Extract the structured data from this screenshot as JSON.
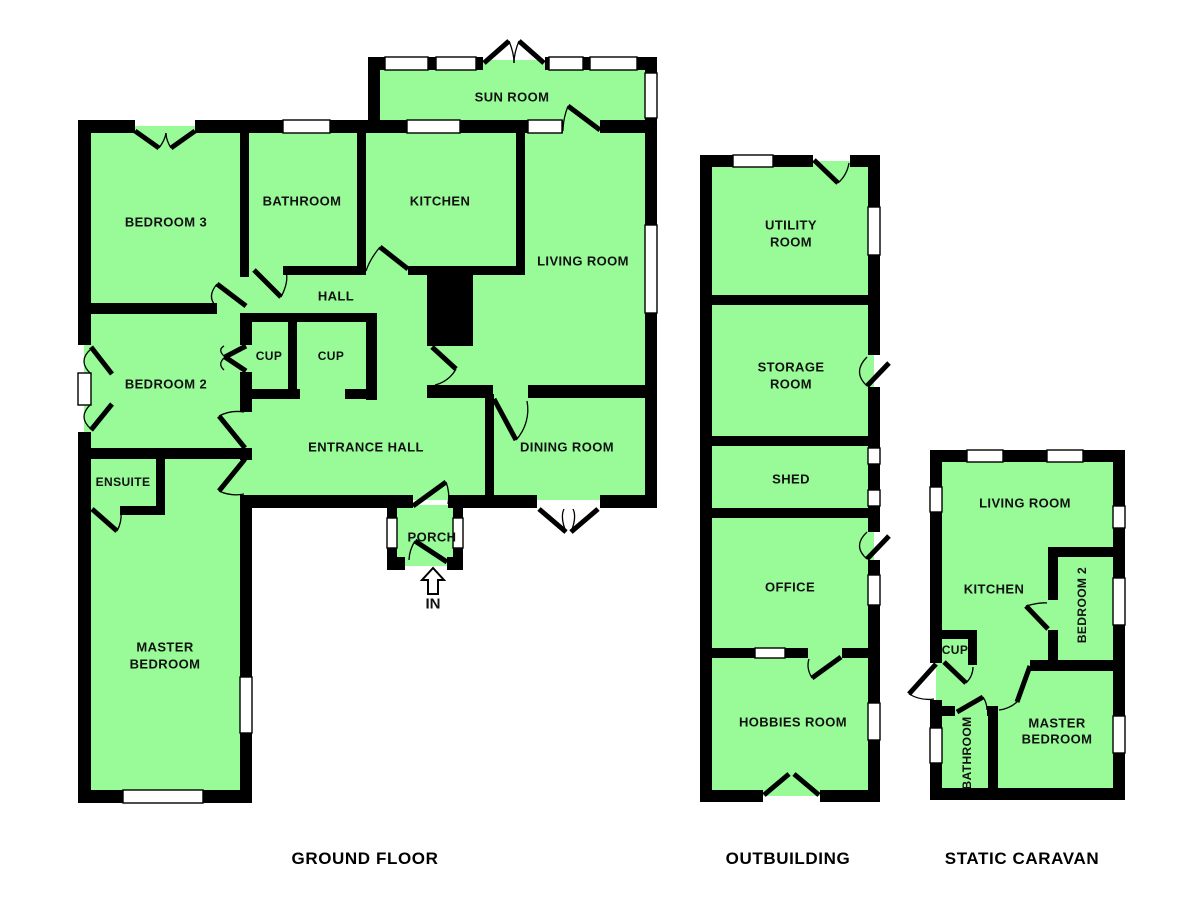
{
  "colors": {
    "floor": "#98FB98",
    "wall": "#000000",
    "window": "#ffffff",
    "text": "#111111"
  },
  "titles": {
    "ground_floor": {
      "text": "GROUND FLOOR"
    },
    "outbuilding": {
      "text": "OUTBUILDING"
    },
    "static_caravan": {
      "text": "STATIC CARAVAN"
    }
  },
  "entrance": {
    "label": "IN",
    "arrow_points": "433,568 422,580 428,580 428,594 438,594 438,580 444,580",
    "x": 433,
    "y": 604
  },
  "plan": {
    "floors": [
      [
        374,
        60,
        277,
        73
      ],
      [
        84,
        126,
        567,
        268
      ],
      [
        84,
        394,
        567,
        106
      ],
      [
        84,
        450,
        162,
        347
      ],
      [
        390,
        505,
        70,
        61
      ],
      [
        706,
        161,
        168,
        635
      ],
      [
        936,
        456,
        183,
        338
      ]
    ],
    "walls": [
      [
        368,
        57,
        115,
        13
      ],
      [
        545,
        57,
        112,
        13
      ],
      [
        78,
        120,
        57,
        13
      ],
      [
        195,
        120,
        368,
        13
      ],
      [
        600,
        120,
        57,
        13
      ],
      [
        283,
        266,
        82,
        9
      ],
      [
        408,
        266,
        117,
        9
      ],
      [
        78,
        303,
        139,
        11
      ],
      [
        243,
        313,
        134,
        9
      ],
      [
        243,
        389,
        57,
        10
      ],
      [
        345,
        389,
        32,
        10
      ],
      [
        427,
        385,
        66,
        13
      ],
      [
        528,
        385,
        129,
        13
      ],
      [
        78,
        448,
        170,
        11
      ],
      [
        120,
        506,
        45,
        9
      ],
      [
        243,
        495,
        170,
        13
      ],
      [
        448,
        495,
        89,
        13
      ],
      [
        600,
        495,
        57,
        13
      ],
      [
        387,
        557,
        18,
        13
      ],
      [
        447,
        557,
        16,
        13
      ],
      [
        78,
        790,
        45,
        13
      ],
      [
        203,
        790,
        49,
        13
      ],
      [
        78,
        120,
        13,
        225
      ],
      [
        78,
        432,
        13,
        371
      ],
      [
        240,
        120,
        9,
        157
      ],
      [
        357,
        120,
        9,
        155
      ],
      [
        516,
        126,
        9,
        149
      ],
      [
        368,
        57,
        12,
        76
      ],
      [
        645,
        57,
        12,
        16
      ],
      [
        645,
        118,
        12,
        107
      ],
      [
        645,
        313,
        12,
        195
      ],
      [
        288,
        313,
        9,
        86
      ],
      [
        366,
        313,
        11,
        87
      ],
      [
        240,
        313,
        12,
        32
      ],
      [
        240,
        372,
        12,
        40
      ],
      [
        240,
        448,
        12,
        12
      ],
      [
        240,
        495,
        12,
        182
      ],
      [
        240,
        733,
        12,
        70
      ],
      [
        156,
        448,
        9,
        63
      ],
      [
        485,
        394,
        9,
        107
      ],
      [
        387,
        505,
        10,
        13
      ],
      [
        387,
        548,
        10,
        22
      ],
      [
        453,
        505,
        10,
        13
      ],
      [
        453,
        548,
        10,
        22
      ],
      [
        700,
        155,
        113,
        12
      ],
      [
        850,
        155,
        30,
        12
      ],
      [
        706,
        295,
        168,
        10
      ],
      [
        706,
        436,
        168,
        10
      ],
      [
        706,
        508,
        168,
        10
      ],
      [
        706,
        648,
        49,
        10
      ],
      [
        785,
        648,
        23,
        10
      ],
      [
        842,
        648,
        32,
        10
      ],
      [
        700,
        790,
        63,
        12
      ],
      [
        820,
        790,
        60,
        12
      ],
      [
        700,
        155,
        12,
        647
      ],
      [
        868,
        155,
        12,
        52
      ],
      [
        868,
        255,
        12,
        100
      ],
      [
        868,
        387,
        12,
        61
      ],
      [
        868,
        464,
        12,
        26
      ],
      [
        868,
        506,
        12,
        26
      ],
      [
        868,
        560,
        12,
        15
      ],
      [
        868,
        605,
        12,
        98
      ],
      [
        868,
        740,
        12,
        62
      ],
      [
        930,
        450,
        195,
        12
      ],
      [
        1048,
        547,
        77,
        10
      ],
      [
        1030,
        660,
        95,
        11
      ],
      [
        936,
        630,
        40,
        9
      ],
      [
        936,
        706,
        19,
        10
      ],
      [
        987,
        706,
        11,
        10
      ],
      [
        930,
        788,
        195,
        12
      ],
      [
        930,
        450,
        12,
        37
      ],
      [
        930,
        512,
        12,
        151
      ],
      [
        930,
        700,
        12,
        28
      ],
      [
        930,
        763,
        12,
        37
      ],
      [
        1113,
        450,
        12,
        56
      ],
      [
        1113,
        528,
        12,
        50
      ],
      [
        1113,
        625,
        12,
        91
      ],
      [
        1113,
        753,
        12,
        47
      ],
      [
        1048,
        547,
        10,
        53
      ],
      [
        1048,
        630,
        10,
        35
      ],
      [
        968,
        630,
        9,
        35
      ],
      [
        988,
        706,
        10,
        94
      ]
    ],
    "solids": [
      [
        427,
        266,
        46,
        80
      ]
    ],
    "windows": [
      [
        385,
        57,
        43,
        13
      ],
      [
        436,
        57,
        40,
        13
      ],
      [
        549,
        57,
        34,
        13
      ],
      [
        590,
        57,
        47,
        13
      ],
      [
        645,
        73,
        12,
        45
      ],
      [
        283,
        120,
        47,
        13
      ],
      [
        407,
        120,
        53,
        13
      ],
      [
        528,
        120,
        34,
        13
      ],
      [
        645,
        225,
        12,
        88
      ],
      [
        78,
        373,
        13,
        32
      ],
      [
        240,
        677,
        12,
        56
      ],
      [
        123,
        790,
        80,
        13
      ],
      [
        387,
        518,
        10,
        30
      ],
      [
        453,
        518,
        10,
        30
      ],
      [
        733,
        155,
        40,
        12
      ],
      [
        868,
        207,
        12,
        48
      ],
      [
        868,
        448,
        12,
        16
      ],
      [
        868,
        490,
        12,
        16
      ],
      [
        868,
        575,
        12,
        30
      ],
      [
        755,
        648,
        30,
        10
      ],
      [
        868,
        703,
        12,
        37
      ],
      [
        967,
        450,
        36,
        12
      ],
      [
        1047,
        450,
        36,
        12
      ],
      [
        930,
        487,
        12,
        25
      ],
      [
        930,
        728,
        12,
        35
      ],
      [
        1113,
        506,
        12,
        22
      ],
      [
        1113,
        578,
        12,
        47
      ],
      [
        1113,
        716,
        12,
        37
      ]
    ],
    "door_leaves": [
      [
        484,
        63,
        509,
        41
      ],
      [
        544,
        63,
        519,
        41
      ],
      [
        135,
        131,
        159,
        148
      ],
      [
        195,
        131,
        171,
        148
      ],
      [
        600,
        130,
        568,
        106
      ],
      [
        254,
        270,
        281,
        297
      ],
      [
        408,
        269,
        380,
        247
      ],
      [
        246,
        306,
        217,
        284
      ],
      [
        246,
        346,
        225,
        357
      ],
      [
        246,
        371,
        225,
        357
      ],
      [
        245,
        448,
        219,
        416
      ],
      [
        245,
        459,
        219,
        491
      ],
      [
        92,
        509,
        117,
        531
      ],
      [
        413,
        506,
        446,
        482
      ],
      [
        447,
        562,
        415,
        541
      ],
      [
        494,
        399,
        516,
        440
      ],
      [
        539,
        509,
        566,
        532
      ],
      [
        598,
        509,
        571,
        532
      ],
      [
        432,
        347,
        456,
        369
      ],
      [
        91,
        347,
        112,
        374
      ],
      [
        91,
        430,
        112,
        404
      ],
      [
        814,
        160,
        838,
        183
      ],
      [
        867,
        386,
        889,
        363
      ],
      [
        867,
        559,
        889,
        536
      ],
      [
        841,
        657,
        812,
        678
      ],
      [
        764,
        795,
        789,
        774
      ],
      [
        819,
        795,
        794,
        774
      ],
      [
        1048,
        629,
        1026,
        606
      ],
      [
        936,
        664,
        909,
        694
      ],
      [
        944,
        662,
        966,
        683
      ],
      [
        957,
        712,
        983,
        697
      ],
      [
        1030,
        666,
        1017,
        702
      ]
    ],
    "door_arcs": [
      "M509,41 Q514,53 514,63",
      "M519,41 Q514,53 514,63",
      "M159,148 Q165,140 166,133",
      "M171,148 Q166,140 166,133",
      "M568,106 Q563,119 563,131",
      "M281,297 Q289,282 286,271",
      "M380,247 Q370,259 366,271",
      "M217,284 Q207,296 215,305",
      "M225,357 Q217,350 224,346",
      "M225,357 Q217,364 224,370",
      "M219,416 A40,40 0 0 1 244,412",
      "M219,491 A40,40 0 0 0 244,494",
      "M117,531 A33,33 0 0 0 121,512",
      "M446,482 A40,40 0 0 1 448,504",
      "M415,541 A38,38 0 0 0 409,560",
      "M516,440 A45,45 0 0 0 527,401",
      "M566,532 Q560,517 564,509",
      "M571,532 Q577,517 573,509",
      "M456,369 A33,33 0 0 1 435,385",
      "M91,349 Q77,361 91,374",
      "M91,429 Q77,417 91,404",
      "M838,183 A34,34 0 0 0 849,163",
      "M867,357 Q852,372 867,386",
      "M867,532 Q852,546 867,559",
      "M812,678 Q806,668 809,659",
      "M789,774 Q777,781 768,792",
      "M794,774 Q806,781 815,792",
      "M1026,606 Q1041,602 1047,603",
      "M909,694 Q921,701 934,699",
      "M966,683 Q973,676 973,667",
      "M983,697 Q987,703 987,710",
      "M1017,702 Q1009,709 999,710"
    ],
    "labels": [
      {
        "t": "SUN ROOM",
        "x": 512,
        "y": 97
      },
      {
        "t": "BEDROOM 3",
        "x": 166,
        "y": 222
      },
      {
        "t": "BATHROOM",
        "x": 302,
        "y": 201
      },
      {
        "t": "KITCHEN",
        "x": 440,
        "y": 201
      },
      {
        "t": "LIVING ROOM",
        "x": 583,
        "y": 261
      },
      {
        "t": "HALL",
        "x": 336,
        "y": 296
      },
      {
        "t": "CUP",
        "x": 269,
        "y": 356,
        "s": 12
      },
      {
        "t": "CUP",
        "x": 331,
        "y": 356,
        "s": 12
      },
      {
        "t": "BEDROOM 2",
        "x": 166,
        "y": 384
      },
      {
        "t": "ENSUITE",
        "x": 123,
        "y": 482,
        "s": 12
      },
      {
        "t": "ENTRANCE HALL",
        "x": 366,
        "y": 447
      },
      {
        "t": "DINING ROOM",
        "x": 567,
        "y": 447
      },
      {
        "t": "PORCH",
        "x": 432,
        "y": 537
      },
      {
        "t": "MASTER",
        "x": 165,
        "y": 647
      },
      {
        "t": "BEDROOM",
        "x": 165,
        "y": 664
      },
      {
        "t": "UTILITY",
        "x": 791,
        "y": 225
      },
      {
        "t": "ROOM",
        "x": 791,
        "y": 242
      },
      {
        "t": "STORAGE",
        "x": 791,
        "y": 367
      },
      {
        "t": "ROOM",
        "x": 791,
        "y": 384
      },
      {
        "t": "SHED",
        "x": 791,
        "y": 479
      },
      {
        "t": "OFFICE",
        "x": 790,
        "y": 587
      },
      {
        "t": "HOBBIES ROOM",
        "x": 793,
        "y": 722
      },
      {
        "t": "LIVING ROOM",
        "x": 1025,
        "y": 503
      },
      {
        "t": "KITCHEN",
        "x": 994,
        "y": 589
      },
      {
        "t": "BEDROOM 2",
        "x": 1082,
        "y": 605,
        "r": -90,
        "s": 12
      },
      {
        "t": "CUP",
        "x": 955,
        "y": 650,
        "s": 12
      },
      {
        "t": "BATHROOM",
        "x": 967,
        "y": 753,
        "r": -90,
        "s": 12
      },
      {
        "t": "MASTER",
        "x": 1057,
        "y": 723
      },
      {
        "t": "BEDROOM",
        "x": 1057,
        "y": 739
      }
    ]
  }
}
